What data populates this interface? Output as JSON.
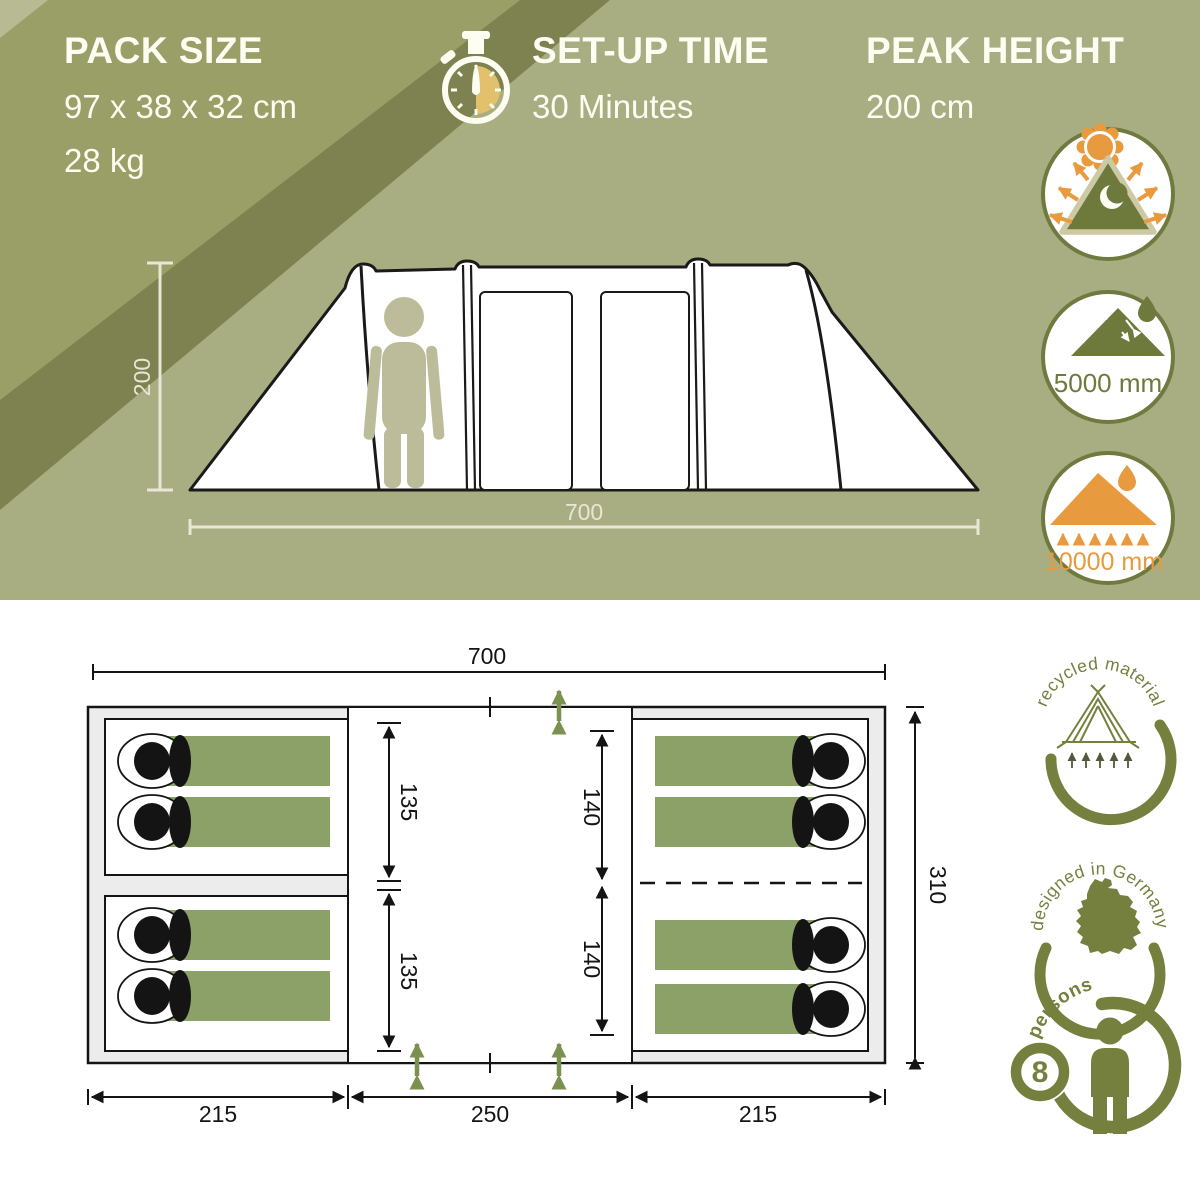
{
  "specs": {
    "pack": {
      "title": "PACK SIZE",
      "dimensions": "97 x 38 x 32 cm",
      "weight": "28 kg"
    },
    "setup": {
      "title": "SET-UP TIME",
      "value": "30 Minutes"
    },
    "peak": {
      "title": "PEAK HEIGHT",
      "value": "200 cm"
    }
  },
  "side_view": {
    "height_label": "200",
    "width_label": "700"
  },
  "top_badges": {
    "flysheet_rating": "5000 mm",
    "groundsheet_rating": "10000 mm"
  },
  "floor_plan": {
    "total_width": "700",
    "total_depth": "310",
    "left_cabin_width": "215",
    "center_width": "250",
    "right_cabin_width": "215",
    "left_depth_top": "135",
    "left_depth_bottom": "135",
    "right_depth_top": "140",
    "right_depth_bottom": "140"
  },
  "bottom_badges": {
    "recycled_label": "recycled material",
    "designed_label": "designed in Germany",
    "persons_count": "8",
    "persons_label": "persons"
  },
  "colors": {
    "sage": "#a9ad82",
    "olive_band": "#9a9e67",
    "dark_band": "#7e8250",
    "badge_olive": "#6f7a3f",
    "icon_olive": "#6d7a3c",
    "orange": "#e89a3e",
    "bag_green": "#8ca167",
    "beige_dim": "#e9e6d5",
    "plan_arrow_green": "#7b9150",
    "floor_gray": "#ececec",
    "line_black": "#141414",
    "bottom_badge_olive": "#76803e",
    "person_beige": "#bcbc9b",
    "watch_yellow": "#e2c06c"
  }
}
